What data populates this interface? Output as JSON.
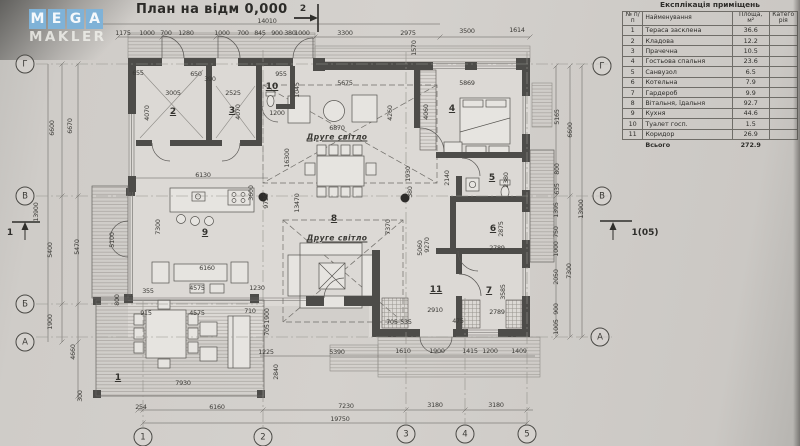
{
  "logo": {
    "letters": [
      "M",
      "E",
      "G",
      "A"
    ],
    "word2": "MAKLER"
  },
  "title": "План на відм 0,000",
  "table": {
    "title": "Експлікація приміщень",
    "col_num": "№ п/п",
    "col_name": "Найменування",
    "col_area": "Площа, м²",
    "col_cat": "Категорія",
    "rows": [
      {
        "num": "1",
        "name": "Тераса засклена",
        "area": "36.6",
        "cat": ""
      },
      {
        "num": "2",
        "name": "Кладова",
        "area": "12.2",
        "cat": ""
      },
      {
        "num": "3",
        "name": "Прачечна",
        "area": "10.5",
        "cat": ""
      },
      {
        "num": "4",
        "name": "Гостьова спальня",
        "area": "23.6",
        "cat": ""
      },
      {
        "num": "5",
        "name": "Санвузол",
        "area": "6.5",
        "cat": ""
      },
      {
        "num": "6",
        "name": "Котельна",
        "area": "7.9",
        "cat": ""
      },
      {
        "num": "7",
        "name": "Гардероб",
        "area": "9.9",
        "cat": ""
      },
      {
        "num": "8",
        "name": "Вітальня, їдальня",
        "area": "92.7",
        "cat": ""
      },
      {
        "num": "9",
        "name": "Кухня",
        "area": "44.6",
        "cat": ""
      },
      {
        "num": "10",
        "name": "Туалет госп.",
        "area": "1.5",
        "cat": ""
      },
      {
        "num": "11",
        "name": "Коридор",
        "area": "26.9",
        "cat": ""
      }
    ],
    "total_label": "Всього",
    "total_value": "272.9"
  },
  "axis_circles": [
    {
      "t": "Г",
      "x": 25,
      "y": 64
    },
    {
      "t": "В",
      "x": 25,
      "y": 196
    },
    {
      "t": "Б",
      "x": 25,
      "y": 304
    },
    {
      "t": "А",
      "x": 25,
      "y": 342
    },
    {
      "t": "Г",
      "x": 602,
      "y": 66
    },
    {
      "t": "В",
      "x": 602,
      "y": 196
    },
    {
      "t": "А",
      "x": 600,
      "y": 337
    },
    {
      "t": "1",
      "x": 143,
      "y": 437
    },
    {
      "t": "2",
      "x": 263,
      "y": 437
    },
    {
      "t": "3",
      "x": 406,
      "y": 434
    },
    {
      "t": "4",
      "x": 465,
      "y": 434
    },
    {
      "t": "5",
      "x": 527,
      "y": 434
    }
  ],
  "section_markers": [
    {
      "t": "2",
      "x": 303,
      "y": 9
    },
    {
      "t": "1",
      "x": 10,
      "y": 233
    },
    {
      "t": "1(05)",
      "x": 645,
      "y": 233
    }
  ],
  "room_numbers": [
    {
      "t": "1",
      "x": 118,
      "y": 378
    },
    {
      "t": "2",
      "x": 173,
      "y": 112
    },
    {
      "t": "3",
      "x": 232,
      "y": 111
    },
    {
      "t": "4",
      "x": 452,
      "y": 109
    },
    {
      "t": "5",
      "x": 492,
      "y": 178
    },
    {
      "t": "6",
      "x": 493,
      "y": 229
    },
    {
      "t": "7",
      "x": 489,
      "y": 291
    },
    {
      "t": "8",
      "x": 334,
      "y": 219
    },
    {
      "t": "9",
      "x": 205,
      "y": 233
    },
    {
      "t": "10",
      "x": 272,
      "y": 87
    },
    {
      "t": "11",
      "x": 436,
      "y": 290
    }
  ],
  "annotations": [
    {
      "t": "Друге світло",
      "x": 337,
      "y": 137
    },
    {
      "t": "Друге світло",
      "x": 337,
      "y": 238
    }
  ],
  "dimensions": [
    {
      "t": "14010",
      "x": 267,
      "y": 21
    },
    {
      "t": "1175",
      "x": 123,
      "y": 33
    },
    {
      "t": "1000",
      "x": 147,
      "y": 33
    },
    {
      "t": "700",
      "x": 166,
      "y": 33
    },
    {
      "t": "1280",
      "x": 186,
      "y": 33
    },
    {
      "t": "1000",
      "x": 222,
      "y": 33
    },
    {
      "t": "700",
      "x": 243,
      "y": 33
    },
    {
      "t": "845",
      "x": 260,
      "y": 33
    },
    {
      "t": "900",
      "x": 277,
      "y": 33
    },
    {
      "t": "380",
      "x": 290,
      "y": 33
    },
    {
      "t": "1000",
      "x": 302,
      "y": 33
    },
    {
      "t": "3300",
      "x": 345,
      "y": 33
    },
    {
      "t": "2975",
      "x": 408,
      "y": 33
    },
    {
      "t": "3500",
      "x": 467,
      "y": 31
    },
    {
      "t": "1614",
      "x": 517,
      "y": 30
    },
    {
      "t": "1570",
      "x": 414,
      "y": 48,
      "r": 1
    },
    {
      "t": "13900",
      "x": 36,
      "y": 212,
      "r": 1
    },
    {
      "t": "6600",
      "x": 52,
      "y": 128,
      "r": 1
    },
    {
      "t": "5400",
      "x": 50,
      "y": 250,
      "r": 1
    },
    {
      "t": "1900",
      "x": 50,
      "y": 322,
      "r": 1
    },
    {
      "t": "6670",
      "x": 70,
      "y": 126,
      "r": 1
    },
    {
      "t": "5470",
      "x": 77,
      "y": 247,
      "r": 1
    },
    {
      "t": "4660",
      "x": 73,
      "y": 352,
      "r": 1
    },
    {
      "t": "300",
      "x": 80,
      "y": 396,
      "r": 1
    },
    {
      "t": "5165",
      "x": 557,
      "y": 117,
      "r": 1
    },
    {
      "t": "800",
      "x": 557,
      "y": 169,
      "r": 1
    },
    {
      "t": "635",
      "x": 557,
      "y": 189,
      "r": 1
    },
    {
      "t": "1395",
      "x": 556,
      "y": 210,
      "r": 1
    },
    {
      "t": "750",
      "x": 556,
      "y": 232,
      "r": 1
    },
    {
      "t": "1000",
      "x": 556,
      "y": 249,
      "r": 1
    },
    {
      "t": "2050",
      "x": 556,
      "y": 277,
      "r": 1
    },
    {
      "t": "900",
      "x": 556,
      "y": 309,
      "r": 1
    },
    {
      "t": "1005",
      "x": 556,
      "y": 327,
      "r": 1
    },
    {
      "t": "6600",
      "x": 570,
      "y": 130,
      "r": 1
    },
    {
      "t": "7300",
      "x": 569,
      "y": 271,
      "r": 1
    },
    {
      "t": "13900",
      "x": 581,
      "y": 209,
      "r": 1
    },
    {
      "t": "1225",
      "x": 266,
      "y": 352
    },
    {
      "t": "5390",
      "x": 337,
      "y": 352
    },
    {
      "t": "1610",
      "x": 403,
      "y": 351
    },
    {
      "t": "1900",
      "x": 437,
      "y": 351
    },
    {
      "t": "1415",
      "x": 470,
      "y": 351
    },
    {
      "t": "1200",
      "x": 490,
      "y": 351
    },
    {
      "t": "1409",
      "x": 519,
      "y": 351
    },
    {
      "t": "2840",
      "x": 276,
      "y": 372,
      "r": 1
    },
    {
      "t": "7930",
      "x": 183,
      "y": 383
    },
    {
      "t": "254",
      "x": 141,
      "y": 407
    },
    {
      "t": "6160",
      "x": 217,
      "y": 407
    },
    {
      "t": "7230",
      "x": 346,
      "y": 406
    },
    {
      "t": "3180",
      "x": 435,
      "y": 405
    },
    {
      "t": "3180",
      "x": 496,
      "y": 405
    },
    {
      "t": "19750",
      "x": 340,
      "y": 419
    },
    {
      "t": "655",
      "x": 138,
      "y": 73
    },
    {
      "t": "650",
      "x": 196,
      "y": 74
    },
    {
      "t": "390",
      "x": 210,
      "y": 79
    },
    {
      "t": "3005",
      "x": 173,
      "y": 93
    },
    {
      "t": "2525",
      "x": 233,
      "y": 93
    },
    {
      "t": "4070",
      "x": 147,
      "y": 113,
      "r": 1
    },
    {
      "t": "4070",
      "x": 238,
      "y": 112,
      "r": 1
    },
    {
      "t": "955",
      "x": 281,
      "y": 74
    },
    {
      "t": "1045",
      "x": 297,
      "y": 90,
      "r": 1
    },
    {
      "t": "1200",
      "x": 277,
      "y": 113
    },
    {
      "t": "6130",
      "x": 203,
      "y": 175
    },
    {
      "t": "3600",
      "x": 251,
      "y": 193,
      "r": 1
    },
    {
      "t": "7300",
      "x": 158,
      "y": 227,
      "r": 1
    },
    {
      "t": "5100",
      "x": 112,
      "y": 240,
      "r": 1
    },
    {
      "t": "6160",
      "x": 207,
      "y": 268
    },
    {
      "t": "4575",
      "x": 197,
      "y": 288
    },
    {
      "t": "355",
      "x": 148,
      "y": 291
    },
    {
      "t": "1230",
      "x": 257,
      "y": 288
    },
    {
      "t": "800",
      "x": 117,
      "y": 300,
      "r": 1
    },
    {
      "t": "915",
      "x": 146,
      "y": 313
    },
    {
      "t": "4575",
      "x": 197,
      "y": 313
    },
    {
      "t": "710",
      "x": 250,
      "y": 311
    },
    {
      "t": "1900",
      "x": 267,
      "y": 316,
      "r": 1
    },
    {
      "t": "705",
      "x": 267,
      "y": 330,
      "r": 1
    },
    {
      "t": "5675",
      "x": 345,
      "y": 83
    },
    {
      "t": "6870",
      "x": 337,
      "y": 128
    },
    {
      "t": "4260",
      "x": 390,
      "y": 113,
      "r": 1
    },
    {
      "t": "4060",
      "x": 426,
      "y": 112,
      "r": 1
    },
    {
      "t": "5869",
      "x": 467,
      "y": 83
    },
    {
      "t": "9725",
      "x": 266,
      "y": 201,
      "r": 1
    },
    {
      "t": "13470",
      "x": 297,
      "y": 203,
      "r": 1
    },
    {
      "t": "16300",
      "x": 287,
      "y": 158,
      "r": 1
    },
    {
      "t": "2140",
      "x": 447,
      "y": 178,
      "r": 1
    },
    {
      "t": "2380",
      "x": 506,
      "y": 180,
      "r": 1
    },
    {
      "t": "1930",
      "x": 408,
      "y": 174,
      "r": 1
    },
    {
      "t": "380",
      "x": 410,
      "y": 192,
      "r": 1
    },
    {
      "t": "2910",
      "x": 435,
      "y": 310
    },
    {
      "t": "2789",
      "x": 497,
      "y": 312
    },
    {
      "t": "2789",
      "x": 497,
      "y": 248
    },
    {
      "t": "2875",
      "x": 501,
      "y": 229,
      "r": 1
    },
    {
      "t": "3585",
      "x": 503,
      "y": 292,
      "r": 1
    },
    {
      "t": "705",
      "x": 392,
      "y": 322
    },
    {
      "t": "535",
      "x": 406,
      "y": 322
    },
    {
      "t": "475",
      "x": 458,
      "y": 321
    },
    {
      "t": "7370",
      "x": 388,
      "y": 227,
      "r": 1
    },
    {
      "t": "5060",
      "x": 420,
      "y": 248,
      "r": 1
    },
    {
      "t": "9270",
      "x": 427,
      "y": 245,
      "r": 1
    }
  ]
}
